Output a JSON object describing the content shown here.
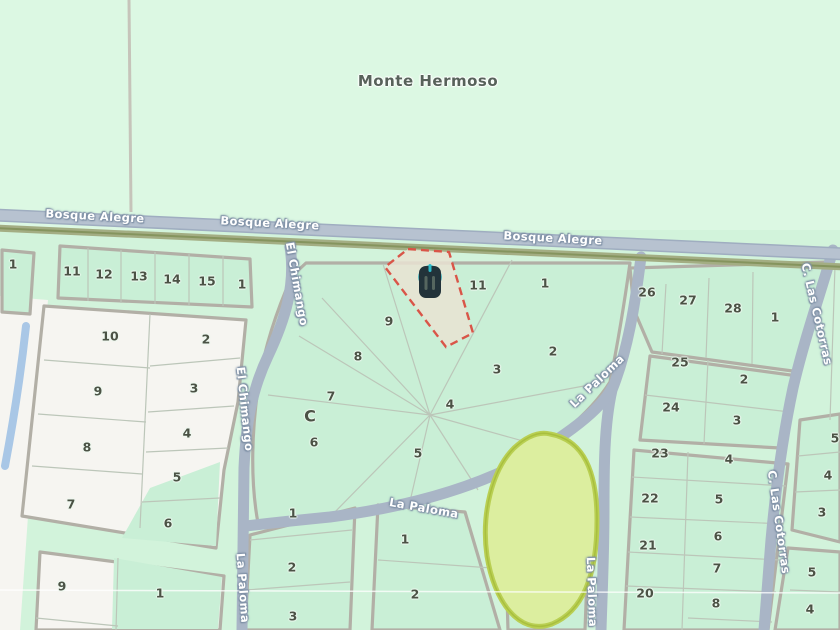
{
  "place": {
    "name": "Monte Hermoso"
  },
  "block_label": {
    "text": "C"
  },
  "colors": {
    "background_north": "#dcf8e3",
    "background_south": "#d2f3db",
    "parcel_green": "#c9efd6",
    "unzoned_white": "#f6f5f1",
    "street_band": "#a9b5c6",
    "road_casing": "#b2afa6",
    "tree_line_olive": "#9aa67c",
    "stream_blue": "#a9c7e6",
    "pond_fill": "#dcee9f",
    "pond_border": "#b9cf52",
    "selected_lot_outline": "#d95548",
    "selected_lot_fill": "#e9e3d2",
    "marker_teal": "#2bbccb",
    "marker_body": "#22333a"
  },
  "marker": {
    "kind": "property-location-pin"
  },
  "selected_lot": {
    "style": "dashed-red-outline"
  },
  "street_labels": [
    {
      "name": "Bosque Alegre",
      "x": 95,
      "y": 216,
      "rot": 3
    },
    {
      "name": "Bosque Alegre",
      "x": 270,
      "y": 223,
      "rot": 3
    },
    {
      "name": "Bosque Alegre",
      "x": 553,
      "y": 238,
      "rot": 3
    },
    {
      "name": "El Chimango",
      "x": 297,
      "y": 284,
      "rot": 80
    },
    {
      "name": "El Chimango",
      "x": 245,
      "y": 409,
      "rot": 84
    },
    {
      "name": "La Paloma",
      "x": 597,
      "y": 381,
      "rot": -44
    },
    {
      "name": "La Paloma",
      "x": 424,
      "y": 508,
      "rot": 10
    },
    {
      "name": "La Paloma",
      "x": 592,
      "y": 592,
      "rot": 88
    },
    {
      "name": "La Paloma",
      "x": 243,
      "y": 588,
      "rot": 86
    },
    {
      "name": "C. Las Cotorras",
      "x": 817,
      "y": 314,
      "rot": 77
    },
    {
      "name": "C. Las Cotorras",
      "x": 779,
      "y": 522,
      "rot": 82
    }
  ],
  "lot_numbers": [
    {
      "t": "1",
      "x": 13,
      "y": 264
    },
    {
      "t": "11",
      "x": 72,
      "y": 271
    },
    {
      "t": "12",
      "x": 104,
      "y": 274
    },
    {
      "t": "13",
      "x": 139,
      "y": 276
    },
    {
      "t": "14",
      "x": 172,
      "y": 279
    },
    {
      "t": "15",
      "x": 207,
      "y": 281
    },
    {
      "t": "1",
      "x": 242,
      "y": 284
    },
    {
      "t": "10",
      "x": 110,
      "y": 336
    },
    {
      "t": "2",
      "x": 206,
      "y": 339
    },
    {
      "t": "9",
      "x": 98,
      "y": 391
    },
    {
      "t": "3",
      "x": 194,
      "y": 388
    },
    {
      "t": "8",
      "x": 87,
      "y": 447
    },
    {
      "t": "4",
      "x": 187,
      "y": 433
    },
    {
      "t": "7",
      "x": 71,
      "y": 504
    },
    {
      "t": "5",
      "x": 177,
      "y": 477
    },
    {
      "t": "6",
      "x": 168,
      "y": 523
    },
    {
      "t": "9",
      "x": 62,
      "y": 586
    },
    {
      "t": "1",
      "x": 160,
      "y": 593
    },
    {
      "t": "9",
      "x": 389,
      "y": 321
    },
    {
      "t": "11",
      "x": 478,
      "y": 285
    },
    {
      "t": "1",
      "x": 545,
      "y": 283
    },
    {
      "t": "8",
      "x": 358,
      "y": 356
    },
    {
      "t": "3",
      "x": 497,
      "y": 369
    },
    {
      "t": "2",
      "x": 553,
      "y": 351
    },
    {
      "t": "7",
      "x": 331,
      "y": 396
    },
    {
      "t": "4",
      "x": 450,
      "y": 404
    },
    {
      "t": "6",
      "x": 314,
      "y": 442
    },
    {
      "t": "5",
      "x": 418,
      "y": 453
    },
    {
      "t": "1",
      "x": 293,
      "y": 513
    },
    {
      "t": "2",
      "x": 292,
      "y": 567
    },
    {
      "t": "3",
      "x": 293,
      "y": 616
    },
    {
      "t": "1",
      "x": 405,
      "y": 539
    },
    {
      "t": "2",
      "x": 415,
      "y": 594
    },
    {
      "t": "26",
      "x": 647,
      "y": 292
    },
    {
      "t": "27",
      "x": 688,
      "y": 300
    },
    {
      "t": "28",
      "x": 733,
      "y": 308
    },
    {
      "t": "1",
      "x": 775,
      "y": 317
    },
    {
      "t": "25",
      "x": 680,
      "y": 362
    },
    {
      "t": "2",
      "x": 744,
      "y": 379
    },
    {
      "t": "24",
      "x": 671,
      "y": 407
    },
    {
      "t": "3",
      "x": 737,
      "y": 420
    },
    {
      "t": "23",
      "x": 660,
      "y": 453
    },
    {
      "t": "4",
      "x": 729,
      "y": 459
    },
    {
      "t": "22",
      "x": 650,
      "y": 498
    },
    {
      "t": "5",
      "x": 719,
      "y": 499
    },
    {
      "t": "21",
      "x": 648,
      "y": 545
    },
    {
      "t": "6",
      "x": 718,
      "y": 536
    },
    {
      "t": "20",
      "x": 645,
      "y": 593
    },
    {
      "t": "7",
      "x": 717,
      "y": 568
    },
    {
      "t": "8",
      "x": 716,
      "y": 603
    },
    {
      "t": "5",
      "x": 835,
      "y": 438
    },
    {
      "t": "4",
      "x": 828,
      "y": 475
    },
    {
      "t": "3",
      "x": 822,
      "y": 512
    },
    {
      "t": "5",
      "x": 812,
      "y": 572
    },
    {
      "t": "4",
      "x": 810,
      "y": 609
    }
  ]
}
